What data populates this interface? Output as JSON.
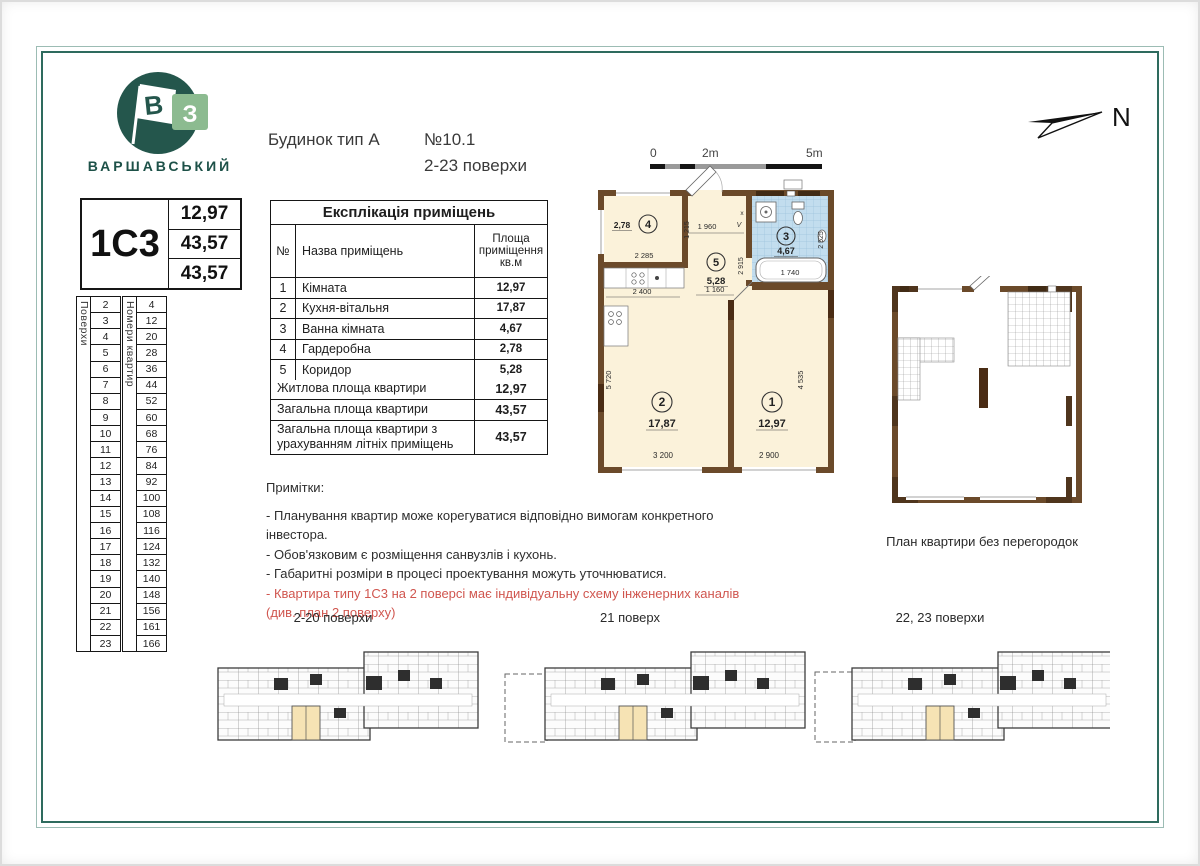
{
  "colors": {
    "frame_teal": "#2e6b5e",
    "wall_brown": "#6b4a2a",
    "room_cream": "#fbf2da",
    "bath_blue": "#c2ddee",
    "unit_highlight": "#f6e3b4",
    "warning_red": "#d0564f"
  },
  "logo": {
    "brand": "ВАРШАВСЬКИЙ",
    "flag_letter": "В",
    "square_letter": "З"
  },
  "header": {
    "building_type": "Будинок тип А",
    "apartment_no": "№10.1",
    "floors_range": "2-23 поверхи"
  },
  "compass": {
    "north_label": "N"
  },
  "scale_bar": {
    "t0": "0",
    "t2": "2m",
    "t5": "5m"
  },
  "type_card": {
    "type_code": "1С3",
    "values": [
      "12,97",
      "43,57",
      "43,57"
    ]
  },
  "floors_table": {
    "floors_label": "Поверхи",
    "apartments_label": "Номери квартир",
    "rows": [
      {
        "floor": "2",
        "apt": "4"
      },
      {
        "floor": "3",
        "apt": "12"
      },
      {
        "floor": "4",
        "apt": "20"
      },
      {
        "floor": "5",
        "apt": "28"
      },
      {
        "floor": "6",
        "apt": "36"
      },
      {
        "floor": "7",
        "apt": "44"
      },
      {
        "floor": "8",
        "apt": "52"
      },
      {
        "floor": "9",
        "apt": "60"
      },
      {
        "floor": "10",
        "apt": "68"
      },
      {
        "floor": "11",
        "apt": "76"
      },
      {
        "floor": "12",
        "apt": "84"
      },
      {
        "floor": "13",
        "apt": "92"
      },
      {
        "floor": "14",
        "apt": "100"
      },
      {
        "floor": "15",
        "apt": "108"
      },
      {
        "floor": "16",
        "apt": "116"
      },
      {
        "floor": "17",
        "apt": "124"
      },
      {
        "floor": "18",
        "apt": "132"
      },
      {
        "floor": "19",
        "apt": "140"
      },
      {
        "floor": "20",
        "apt": "148"
      },
      {
        "floor": "21",
        "apt": "156"
      },
      {
        "floor": "22",
        "apt": "161"
      },
      {
        "floor": "23",
        "apt": "166"
      }
    ]
  },
  "explication": {
    "title": "Експлікація приміщень",
    "columns": {
      "no": "№",
      "name": "Назва приміщень",
      "area": "Площа\nприміщення\nкв.м"
    },
    "rows": [
      {
        "no": "1",
        "name": "Кімната",
        "area": "12,97"
      },
      {
        "no": "2",
        "name": "Кухня-вітальня",
        "area": "17,87"
      },
      {
        "no": "3",
        "name": "Ванна кімната",
        "area": "4,67"
      },
      {
        "no": "4",
        "name": "Гардеробна",
        "area": "2,78"
      },
      {
        "no": "5",
        "name": "Коридор",
        "area": "5,28"
      }
    ],
    "summary": [
      {
        "label": "Житлова площа квартири",
        "value": "12,97"
      },
      {
        "label": "Загальна площа квартири",
        "value": "43,57"
      },
      {
        "label": "Загальна площа квартири з урахуванням літніх приміщень",
        "value": "43,57"
      }
    ]
  },
  "notes": {
    "title": "Примітки:",
    "items": [
      "- Планування квартир може корегуватися відповідно  вимогам конкретного інвестора.",
      "- Обов'язковим є розміщення санвузлів і кухонь.",
      "- Габаритні розміри в процесі проектування можуть  уточнюватися."
    ],
    "warning_line1": "- Квартира типу 1С3 на 2 поверсі має індивідуальну схему інженерних каналів",
    "warning_line2": "(див. план 2 поверху)"
  },
  "unit_plan": {
    "rooms": [
      {
        "num": "1",
        "area": "12,97"
      },
      {
        "num": "2",
        "area": "17,87"
      },
      {
        "num": "3",
        "area": "4,67"
      },
      {
        "num": "4",
        "area": "2,78"
      },
      {
        "num": "5",
        "area": "5,28"
      }
    ],
    "dims": {
      "d1960": "1 960",
      "d1215": "1 215",
      "d2285": "2 285",
      "d2400": "2 400",
      "d2915": "2 915",
      "d1160": "1 160",
      "d2525": "2 525",
      "d1740": "1 740",
      "d5720": "5 720",
      "d3200": "3 200",
      "d2900": "2 900",
      "d4535": "4 535"
    },
    "duct_marks": [
      "x",
      "V"
    ]
  },
  "open_plan": {
    "caption": "План квартири без перегородок"
  },
  "building_plans": {
    "labels": [
      "2-20 поверхи",
      "21 поверх",
      "22, 23 поверхи"
    ]
  }
}
